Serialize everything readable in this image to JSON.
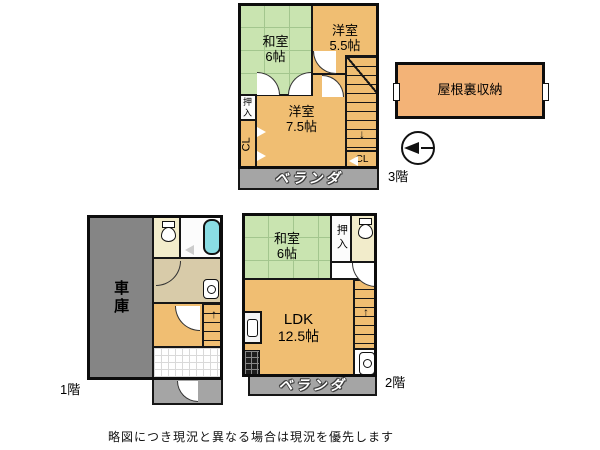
{
  "page": {
    "disclaimer": "略図につき現況と異なる場合は現況を優先します"
  },
  "colors": {
    "wall": "#0d0d0d",
    "room_orange": "#f0be72",
    "attic_orange": "#f3b377",
    "tatami_green": "#c9e4b0",
    "garage_gray": "#858585",
    "veranda_gray": "#a5a5a5",
    "toilet_cream": "#f2eccb",
    "washroom_tan": "#d8cba9",
    "bathtub_cyan": "#8adde4"
  },
  "attic": {
    "label": "屋根裏収納"
  },
  "compass": {
    "icon": "compass-north-arrow",
    "direction": "left"
  },
  "floor3": {
    "label": "3階",
    "rooms": {
      "washitsu": {
        "name": "和室",
        "size": "6帖"
      },
      "youshitsu55": {
        "name": "洋室",
        "size": "5.5帖"
      },
      "youshitsu75": {
        "name": "洋室",
        "size": "7.5帖"
      },
      "oshiire": "押入",
      "closet_left": "CL",
      "closet_right": "CL",
      "veranda": "ベランダ"
    }
  },
  "floor2": {
    "label": "2階",
    "rooms": {
      "washitsu": {
        "name": "和室",
        "size": "6帖"
      },
      "oshiire": "押入",
      "ldk": {
        "name": "LDK",
        "size": "12.5帖"
      },
      "veranda": "ベランダ"
    }
  },
  "floor1": {
    "label": "1階",
    "rooms": {
      "garage": "車庫"
    }
  },
  "icons": {
    "stairs_up": "↑",
    "stairs_down": "↓"
  }
}
